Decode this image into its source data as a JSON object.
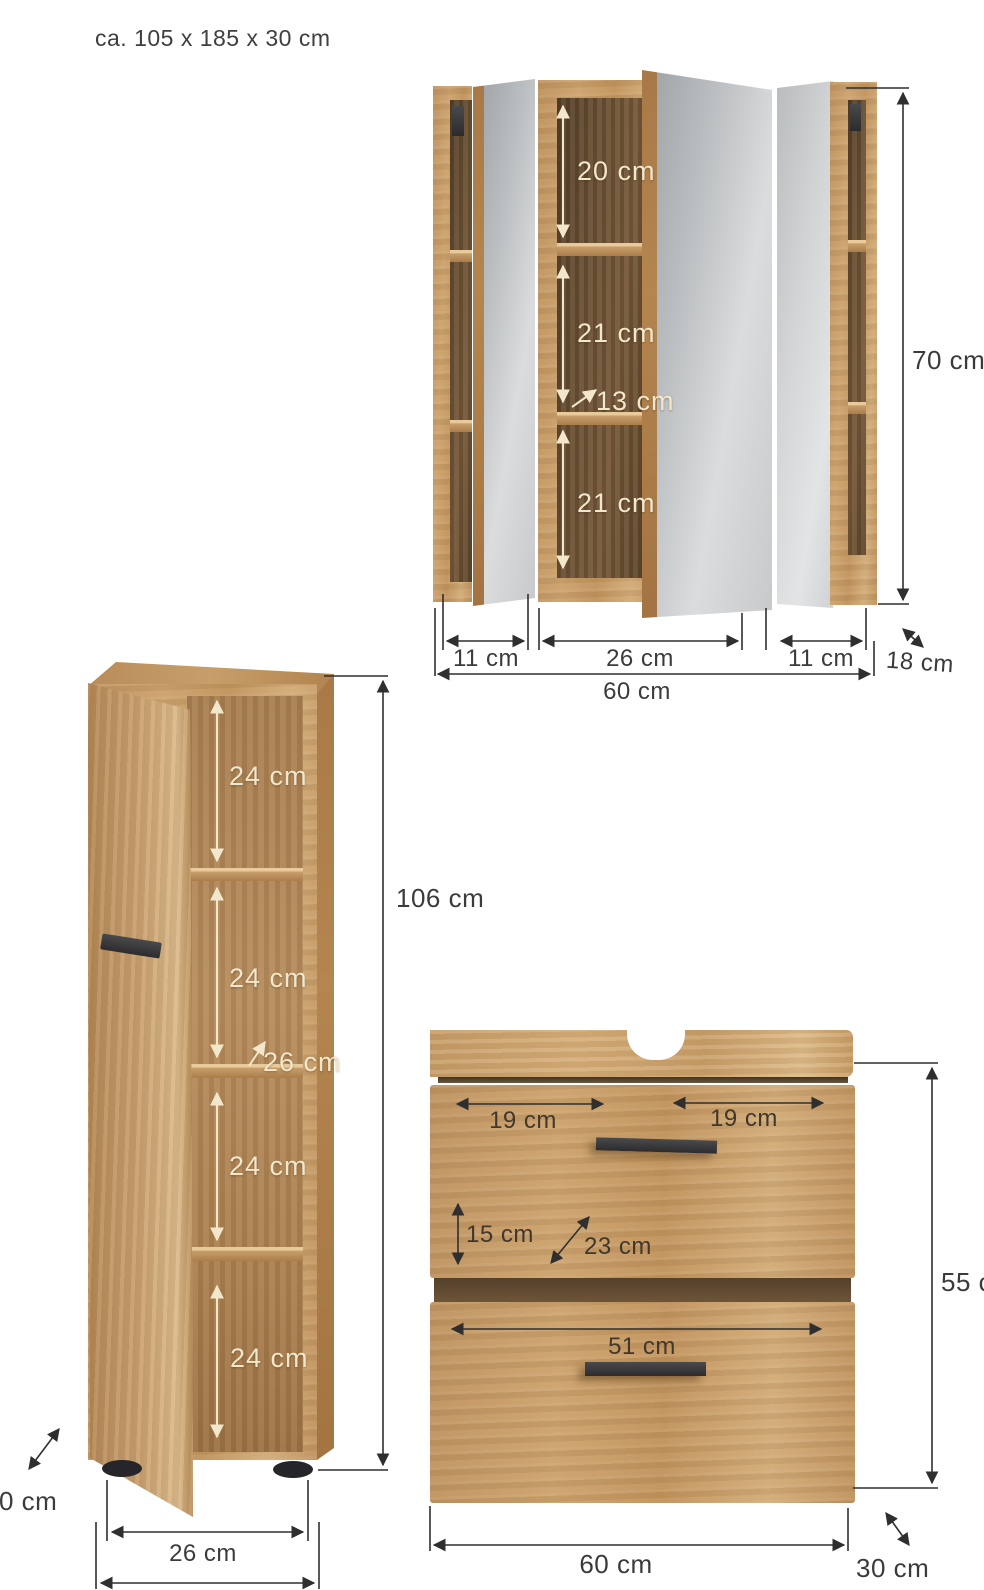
{
  "header": {
    "overall_size": "ca. 105 x 185 x 30 cm"
  },
  "colors": {
    "background": "#ffffff",
    "wood": "#c79e68",
    "wood_interior_dark": "#6b4e2f",
    "wood_interior_light": "#ab804f",
    "mirror": "#c9cbcd",
    "dimension_line": "#2f2f2f",
    "label_on_dark_wood": "#f2e6cb",
    "handle_and_feet": "#38383a"
  },
  "mirror_cabinet": {
    "shelf_top": "20 cm",
    "shelf_middle": "21 cm",
    "shelf_depth": "13 cm",
    "shelf_bottom": "21 cm",
    "height": "70 cm",
    "left_width": "11 cm",
    "center_width": "26 cm",
    "right_width": "11 cm",
    "total_width": "60 cm",
    "depth": "18 cm"
  },
  "tall_cabinet": {
    "compartment_1": "24 cm",
    "compartment_2": "24 cm",
    "shelf_depth": "26 cm",
    "compartment_3": "24 cm",
    "compartment_4": "24 cm",
    "height": "106 cm",
    "depth": "30 cm",
    "inner_width": "26 cm"
  },
  "vanity": {
    "top_left_width": "19 cm",
    "top_right_width": "19 cm",
    "drawer_height": "15 cm",
    "diagonal_depth": "23 cm",
    "drawer_width": "51 cm",
    "total_width": "60 cm",
    "height": "55 cm",
    "depth": "30 cm"
  }
}
